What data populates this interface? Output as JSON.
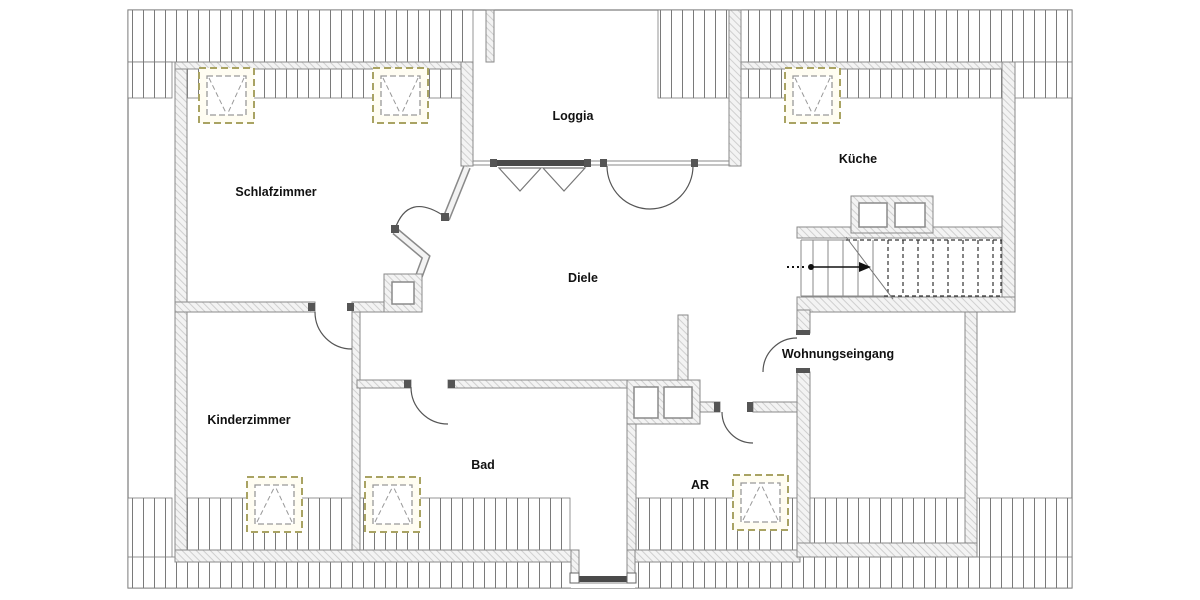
{
  "plan": {
    "type": "attic-apartment-floorplan"
  },
  "rooms": [
    {
      "label": "Schlafzimmer"
    },
    {
      "label": "Loggia"
    },
    {
      "label": "Küche"
    },
    {
      "label": "Diele"
    },
    {
      "label": "Kinderzimmer"
    },
    {
      "label": "Bad"
    },
    {
      "label": "AR"
    },
    {
      "label": "Wohnungseingang"
    }
  ],
  "colors": {
    "skylight": "#a9a363",
    "wall_line": "#8a8a8a",
    "roof_hatch": "#7a7a7a",
    "fixture": "#555555",
    "text": "#111111"
  }
}
